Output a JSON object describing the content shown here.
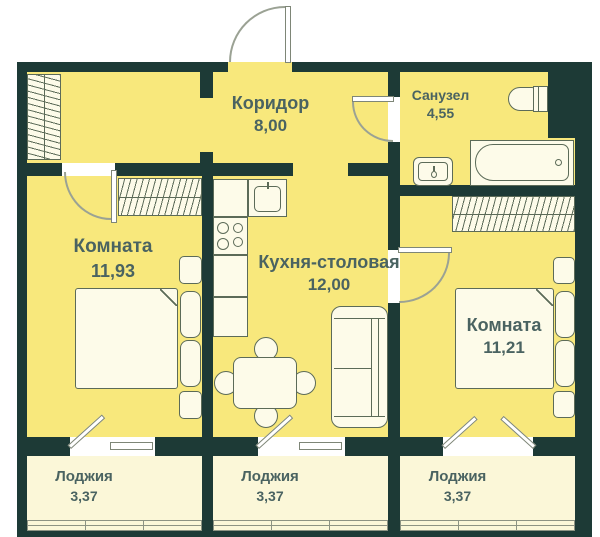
{
  "colors": {
    "wall": "#1d3a36",
    "floor": "#f8e87c",
    "loggia": "#fbf7d8",
    "furn": "#fdfbe9",
    "outline": "#5c6b58",
    "text": "#4a6361"
  },
  "rooms": {
    "corridor": {
      "label": "Коридор",
      "area": "8,00"
    },
    "bathroom": {
      "label": "Санузел",
      "area": "4,55"
    },
    "room_left": {
      "label": "Комната",
      "area": "11,93"
    },
    "kitchen": {
      "label": "Кухня-столовая",
      "area": "12,00"
    },
    "room_right": {
      "label": "Комната",
      "area": "11,21"
    },
    "loggia_left": {
      "label": "Лоджия",
      "area": "3,37"
    },
    "loggia_middle": {
      "label": "Лоджия",
      "area": "3,37"
    },
    "loggia_right": {
      "label": "Лоджия",
      "area": "3,37"
    }
  },
  "fixtures": [
    "entrance-door",
    "wardrobe",
    "bed",
    "nightstand",
    "dining-table",
    "chair",
    "sofa",
    "kitchen-counter",
    "sink",
    "stove",
    "bathtub",
    "washbasin",
    "toilet",
    "balcony-door",
    "window",
    "loggia-glazing"
  ]
}
